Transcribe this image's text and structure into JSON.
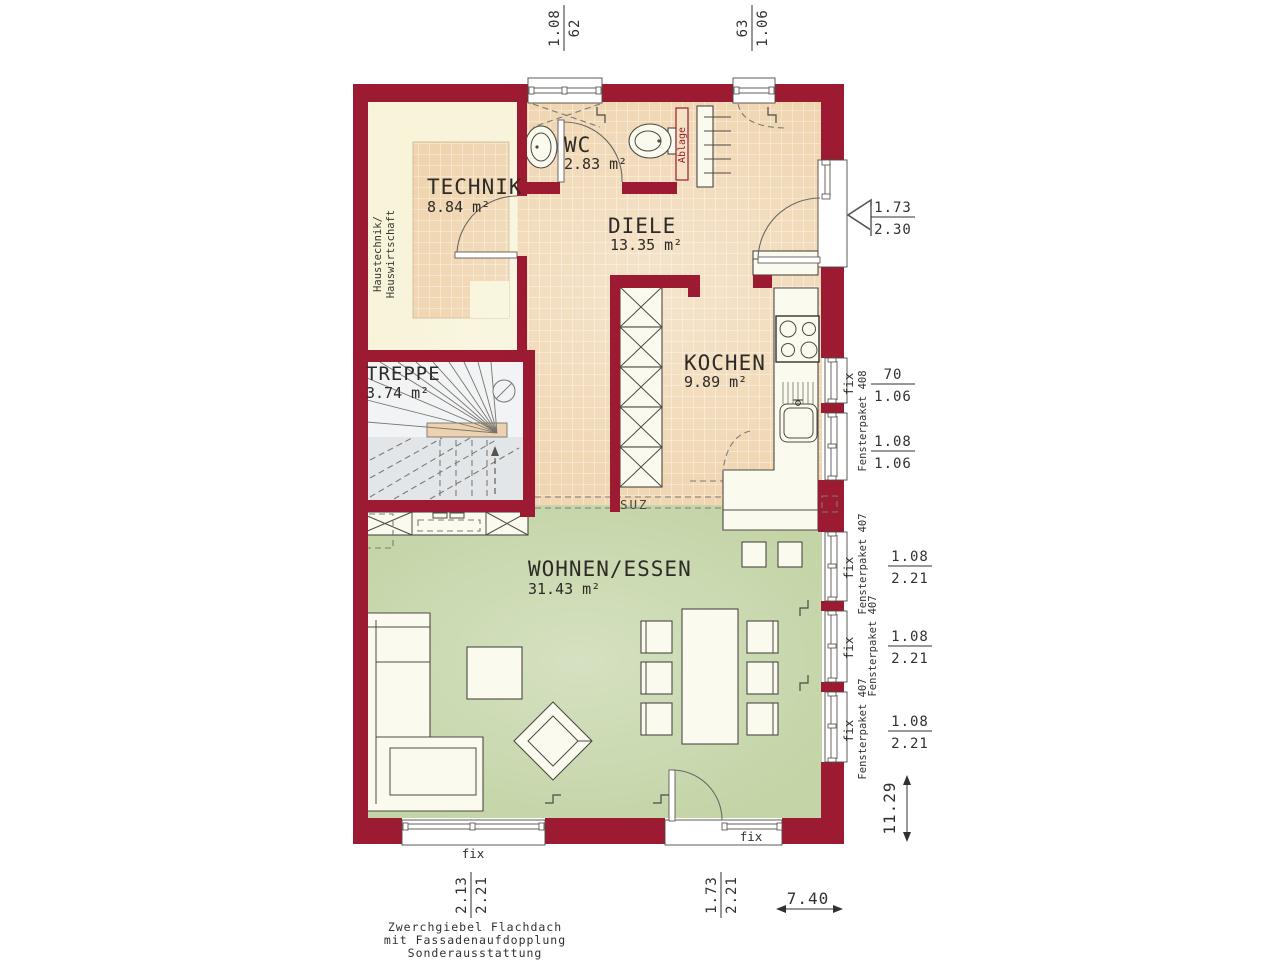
{
  "rooms": {
    "technik": {
      "name": "TECHNIK",
      "area": "8.84 m²"
    },
    "wc": {
      "name": "WC",
      "area": "2.83 m²"
    },
    "diele": {
      "name": "DIELE",
      "area": "13.35 m²"
    },
    "kochen": {
      "name": "KOCHEN",
      "area": "9.89 m²"
    },
    "treppe": {
      "name": "TREPPE",
      "area": "3.74 m²"
    },
    "wohnen": {
      "name": "WOHNEN/ESSEN",
      "area": "31.43 m²"
    }
  },
  "annotations": {
    "haustechnik_line1": "Haustechnik/",
    "haustechnik_line2": "Hauswirtschaft",
    "ablage": "Ablage",
    "suz": "SUZ"
  },
  "labels": {
    "fix": "fix",
    "fensterpaket_408": "Fensterpaket 408",
    "fensterpaket_407": "Fensterpaket 407"
  },
  "dimensions": {
    "top_left": {
      "num": "1.08",
      "den": "62"
    },
    "top_right": {
      "num": "63",
      "den": "1.06"
    },
    "entrance": {
      "num": "1.73",
      "den": "2.30"
    },
    "kitchen_win1": {
      "num": "70",
      "den": "1.06"
    },
    "kitchen_win2": {
      "num": "1.08",
      "den": "1.06"
    },
    "living_win": {
      "num": "1.08",
      "den": "2.21"
    },
    "bottom_left": {
      "num": "2.13",
      "den": "2.21"
    },
    "bottom_right": {
      "num": "1.73",
      "den": "2.21"
    },
    "total_width": "7.40",
    "total_height": "11.29"
  },
  "footer": {
    "line1": "Zwerchgiebel Flachdach",
    "line2": "mit Fassadenaufdopplung",
    "line3": "Sonderausstattung"
  },
  "colors": {
    "wall": "#9c1b32",
    "tile_floor": "#efd4ae",
    "tile_grout": "#f9ecd8",
    "living_floor": "#c3d4a6",
    "technik_floor": "#f8f4da",
    "stair_floor": "#e2e6e9"
  }
}
